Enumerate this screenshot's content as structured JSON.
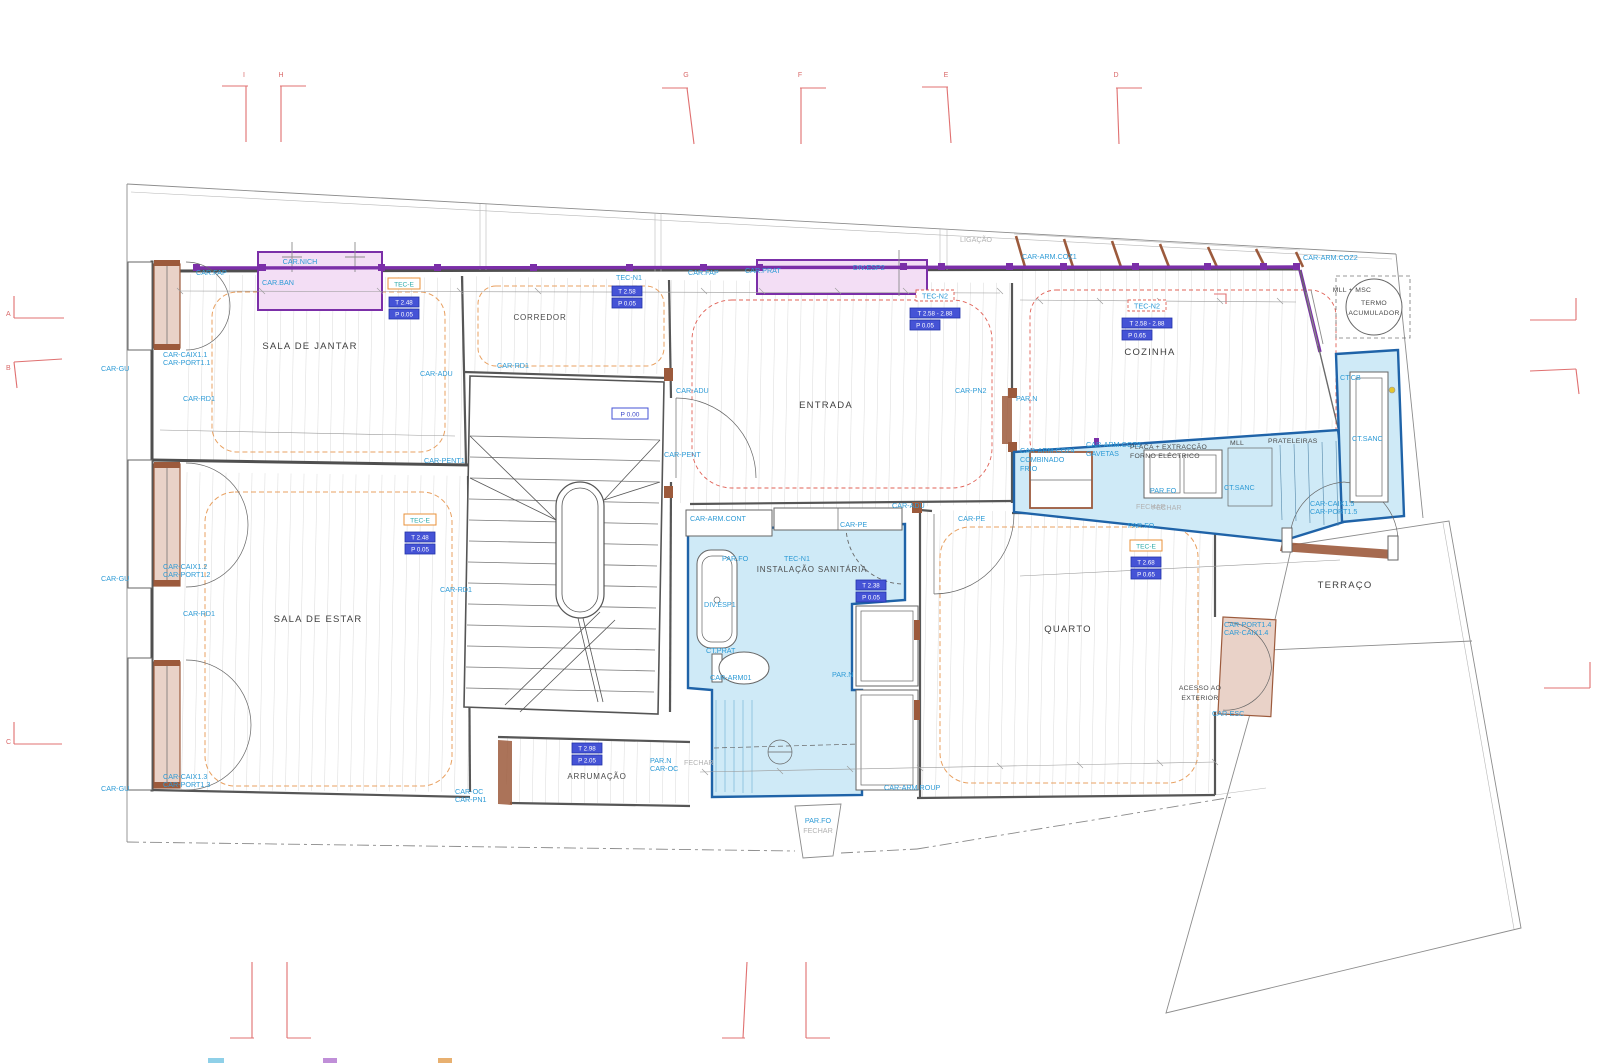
{
  "colors": {
    "accent_purple": "#7b2fa8",
    "cad_blue": "#2e9bd6",
    "cyan_fill": "#cfeaf7",
    "cyan_stroke": "#1f63a8",
    "pink_fill": "#f3def5",
    "wood_brown": "#9c5a3c",
    "reveal_fill": "#e9d2c8",
    "marker_red": "#e07070",
    "orange_dash": "#e8a060",
    "red_dash": "#e06055"
  },
  "grid": {
    "top": [
      "I",
      "H",
      "G",
      "F",
      "E",
      "D"
    ],
    "left": [
      "A",
      "B",
      "C"
    ]
  },
  "rooms": {
    "sala_de_jantar": "SALA DE JANTAR",
    "corredor": "CORREDOR",
    "entrada": "ENTRADA",
    "cozinha": "COZINHA",
    "sala_de_estar": "SALA DE ESTAR",
    "instalacao_sanitaria": "INSTALAÇÃO SANITÁRIA",
    "quarto": "QUARTO",
    "arrumacao": "ARRUMAÇÃO",
    "terraco": "TERRAÇO",
    "acesso": [
      "ACESSO AO",
      "EXTERIOR"
    ]
  },
  "ceilings": {
    "tec_e": "TEC-E",
    "tec_n1": "TEC-N1",
    "tec_n2": "TEC-N2"
  },
  "levels": {
    "jantar_t": "T 2.48",
    "jantar_p": "P 0.05",
    "corredor_t": "T 2.58",
    "corredor_p": "P 0.05",
    "entrada_t": "T 2.58 - 2.88",
    "entrada_p": "P 0.05",
    "cozinha_t": "T 2.58 - 2.88",
    "cozinha_p": "P 0.65",
    "estar_t": "T 2.48",
    "estar_p": "P 0.05",
    "sanitaria_t": "T 2.38",
    "sanitaria_p": "P 0.05",
    "quarto_t": "T 2.68",
    "quarto_p": "P 0.65",
    "arrumacao_t": "T 2.98",
    "arrumacao_p": "P 2.05",
    "zero": "P 0.00"
  },
  "cad": {
    "car_fap": "CAR.FAP",
    "car_nich": "CAR.NICH",
    "car_ban": "CAR.BAN",
    "car_prat": "CAR.PRAT",
    "div_esp1": "DIV.ESP1",
    "div_esp2": "DIV.ESP2",
    "car_gu": "CAR-GU",
    "car_rd1": "CAR-RD1",
    "car_adu": "CAR-ADU",
    "car_pent": "CAR-PENT",
    "car_pent1": "CAR-PENT1",
    "car_pn2": "CAR-PN2",
    "car_pe": "CAR-PE",
    "car_arm_cont": "CAR-ARM.CONT",
    "car_arm01": "CAR-ARM01",
    "ct_prat": "CT.PRAT",
    "par_n": "PAR.N",
    "par_fo": "PAR.FO",
    "fechar": "FECHAR",
    "ligacao": "LIGAÇÃO",
    "caix1": [
      "CAR-CAIX1.1",
      "CAR-PORT1.1"
    ],
    "caix2": [
      "CAR-CAIX1.2",
      "CAR-PORT1.2"
    ],
    "caix3": [
      "CAR-CAIX1.3",
      "CAR-PORT1.3"
    ],
    "caix4": [
      "CAR-PORT1.4",
      "CAR-CAIX1.4"
    ],
    "caix5": [
      "CAR-CAIX1.5",
      "CAR-PORT1.5"
    ],
    "car_oc_pn1": [
      "CAR-OC",
      "CAR-PN1"
    ],
    "par_n_car_oc": [
      "PAR.N",
      "CAR-OC"
    ],
    "car_arm_roup": "CAR-ARM.ROUP",
    "car_esc": "CAR-ESC",
    "coz1": "CAR-ARM.COZ1",
    "coz2": "CAR-ARM.COZ2",
    "coz3": [
      "CAR-ARM.COZ3",
      "GAVETAS"
    ],
    "coz4": [
      "CAR-ARM.COZ4",
      "COMBINADO",
      "FRIO"
    ],
    "placa": [
      "PLACA + EXTRACÇÃO",
      "FORNO ELÉCTRICO"
    ],
    "mll": "MLL",
    "prateleiras": "PRATELEIRAS",
    "mll_msc": "MLL + MSC",
    "termo": [
      "TERMO",
      "ACUMULADOR"
    ],
    "ct_cb": "CT.CB",
    "ct_sanc": "CT.SANC"
  }
}
